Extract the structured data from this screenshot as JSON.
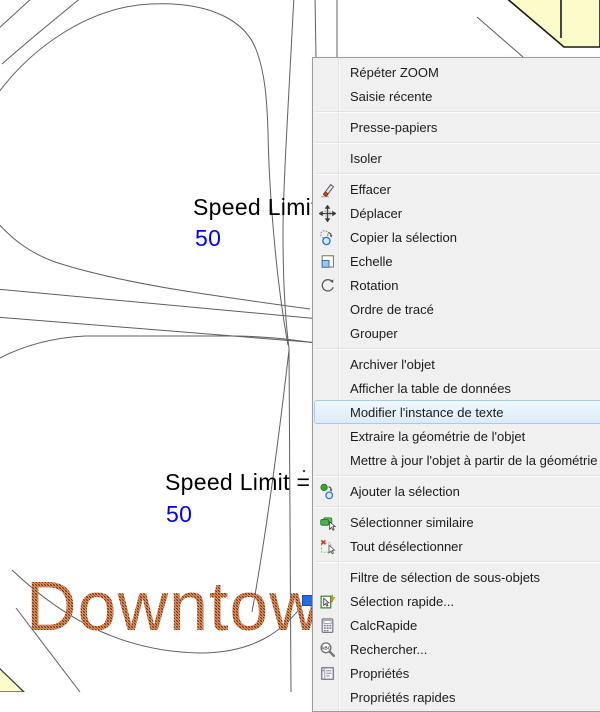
{
  "drawing": {
    "speed_limit_upper": {
      "label": "Speed Limit =",
      "value": "50"
    },
    "speed_limit_lower": {
      "label": "Speed Limit =",
      "value": "50"
    },
    "downtown_label": "Downtown",
    "colors": {
      "value_blue": "#0000ff",
      "line_gray": "#5f5f5f",
      "parcel_yellow": "#fbfcc9",
      "downtown_hatch_dark": "#8a2505",
      "downtown_hatch_light": "#c06a28",
      "grip_blue": "#2a6ae0"
    }
  },
  "context_menu": {
    "items": [
      {
        "type": "item",
        "label": "Répéter ZOOM"
      },
      {
        "type": "item",
        "label": "Saisie récente"
      },
      {
        "type": "separator"
      },
      {
        "type": "item",
        "label": "Presse-papiers"
      },
      {
        "type": "separator"
      },
      {
        "type": "item",
        "label": "Isoler"
      },
      {
        "type": "separator"
      },
      {
        "type": "item",
        "label": "Effacer",
        "icon": "eraser-icon"
      },
      {
        "type": "item",
        "label": "Déplacer",
        "icon": "move-icon"
      },
      {
        "type": "item",
        "label": "Copier la sélection",
        "icon": "copy-selection-icon"
      },
      {
        "type": "item",
        "label": "Echelle",
        "icon": "scale-icon"
      },
      {
        "type": "item",
        "label": "Rotation",
        "icon": "rotate-icon"
      },
      {
        "type": "item",
        "label": "Ordre de tracé"
      },
      {
        "type": "item",
        "label": "Grouper"
      },
      {
        "type": "separator"
      },
      {
        "type": "item",
        "label": "Archiver l'objet"
      },
      {
        "type": "item",
        "label": "Afficher la table de données"
      },
      {
        "type": "item",
        "label": "Modifier l'instance de texte",
        "highlighted": true
      },
      {
        "type": "item",
        "label": "Extraire la géométrie de l'objet"
      },
      {
        "type": "item",
        "label": "Mettre à jour l'objet à partir de la géométrie"
      },
      {
        "type": "separator"
      },
      {
        "type": "item",
        "label": "Ajouter la sélection",
        "icon": "add-selection-icon"
      },
      {
        "type": "separator"
      },
      {
        "type": "item",
        "label": "Sélectionner similaire",
        "icon": "select-similar-icon"
      },
      {
        "type": "item",
        "label": "Tout désélectionner",
        "icon": "deselect-all-icon"
      },
      {
        "type": "separator"
      },
      {
        "type": "item",
        "label": "Filtre de sélection de sous-objets"
      },
      {
        "type": "item",
        "label": "Sélection rapide...",
        "icon": "quick-select-icon"
      },
      {
        "type": "item",
        "label": "CalcRapide",
        "icon": "quickcalc-icon"
      },
      {
        "type": "item",
        "label": "Rechercher...",
        "icon": "find-icon"
      },
      {
        "type": "item",
        "label": "Propriétés",
        "icon": "properties-icon"
      },
      {
        "type": "item",
        "label": "Propriétés rapides"
      }
    ]
  }
}
